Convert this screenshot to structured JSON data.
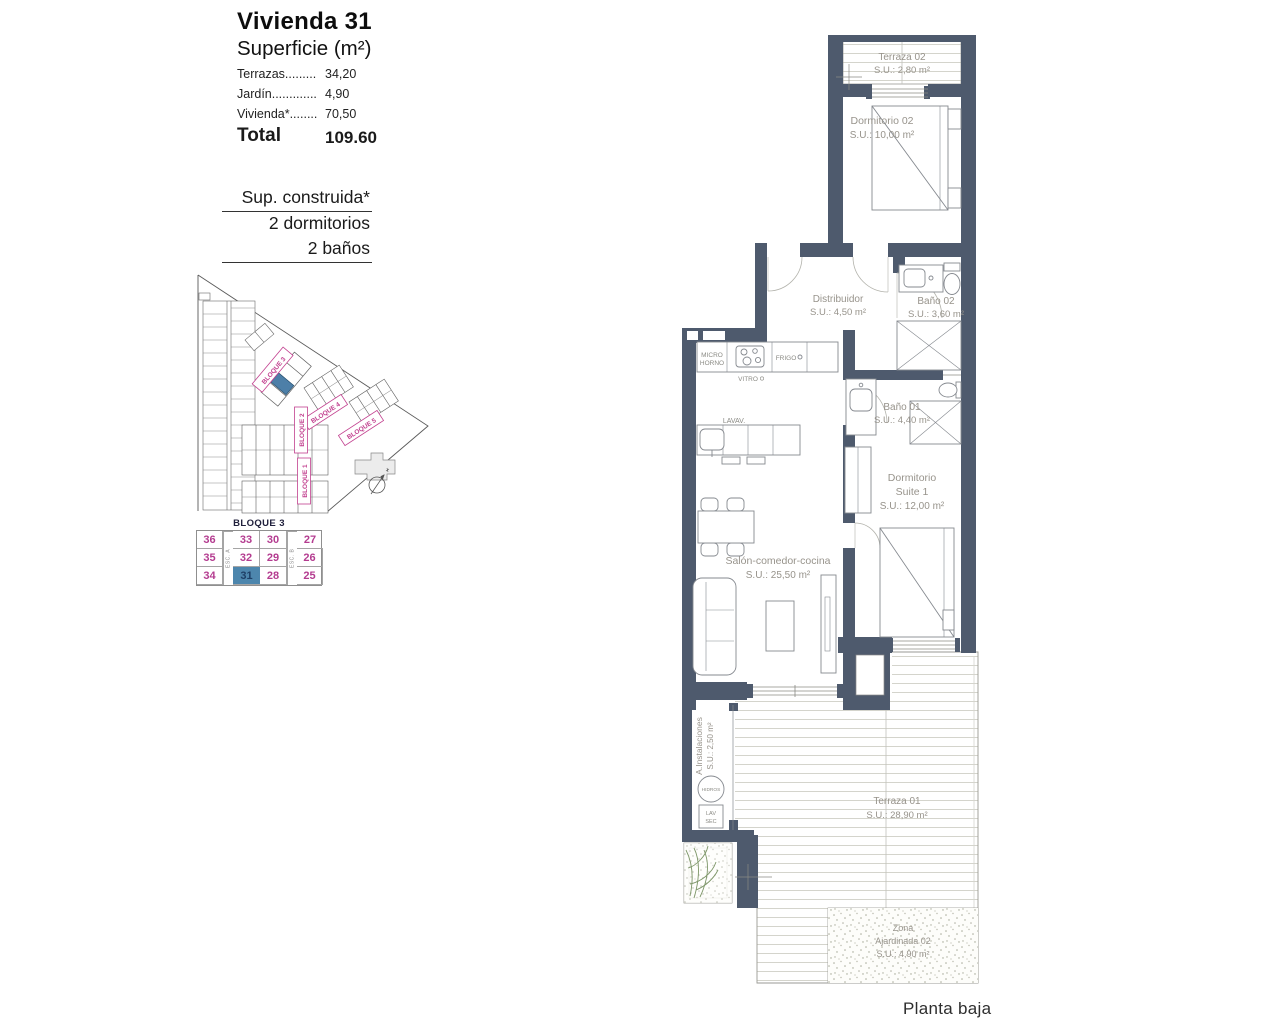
{
  "panel": {
    "title": "Vivienda 31",
    "subtitle": "Superficie (m²)",
    "areas": [
      {
        "label": "Terrazas.........",
        "value": "34,20"
      },
      {
        "label": "Jardín.............",
        "value": "4,90"
      },
      {
        "label": "Vivienda*........",
        "value": "70,50"
      }
    ],
    "total_label": "Total",
    "total_value": "109.60",
    "construida": {
      "line1": "Sup. construida*",
      "line2": "2 dormitorios",
      "line3": "2 baños"
    }
  },
  "site_plan": {
    "labels": {
      "b1": "BLOQUE 1",
      "b2": "BLOQUE 2",
      "b3": "BLOQUE 3",
      "b4": "BLOQUE 4",
      "b5": "BLOQUE 5"
    }
  },
  "unit_table": {
    "title": "BLOQUE 3",
    "esc_a": "ESC. A",
    "esc_b": "ESC. B",
    "highlighted_unit": "31",
    "rows": [
      {
        "cells": [
          "36",
          "33",
          "30",
          "27"
        ]
      },
      {
        "cells": [
          "35",
          "32",
          "29",
          "26"
        ]
      },
      {
        "cells": [
          "34",
          "31",
          "28",
          "25"
        ]
      }
    ]
  },
  "floor_plan": {
    "terraza02": {
      "name": "Terraza 02",
      "area": "S.U.: 2,80 m²"
    },
    "dormitorio02": {
      "name": "Dormitorio 02",
      "area": "S.U.: 10,00 m²"
    },
    "distribuidor": {
      "name": "Distribuidor",
      "area": "S.U.: 4,50 m²"
    },
    "bano02": {
      "name": "Baño 02",
      "area": "S.U.: 3,60 m²"
    },
    "bano01": {
      "name": "Baño 01",
      "area": "S.U.: 4,40 m²"
    },
    "suite": {
      "name": "Dormitorio",
      "name2": "Suite 1",
      "area": "S.U.: 12,00 m²"
    },
    "salon": {
      "name": "Salón-comedor-cocina",
      "area": "S.U.: 25,50 m²"
    },
    "terraza01": {
      "name": "Terraza 01",
      "area": "S.U.: 28,90 m²"
    },
    "zona": {
      "line1": "Zona",
      "line2": "Ajardinada 02",
      "line3": "S.U.: 4,90 m²"
    },
    "instalaciones": {
      "name": "A.Instalaciones",
      "area": "S.U.: 2,50 m²"
    },
    "kitchen": {
      "micro1": "MICRO",
      "micro2": "HORNO",
      "vitro": "VITRO",
      "frigo": "FRIGO",
      "lavav": "LAVAV."
    },
    "utility": {
      "tank": "HIDROS",
      "lav": "LAV",
      "sec": "SEC"
    }
  },
  "footer": {
    "caption": "Planta baja"
  },
  "colors": {
    "wall": "#4e5a6d",
    "accent_pink": "#c2408f",
    "highlight_blue": "#4d7fa8"
  }
}
